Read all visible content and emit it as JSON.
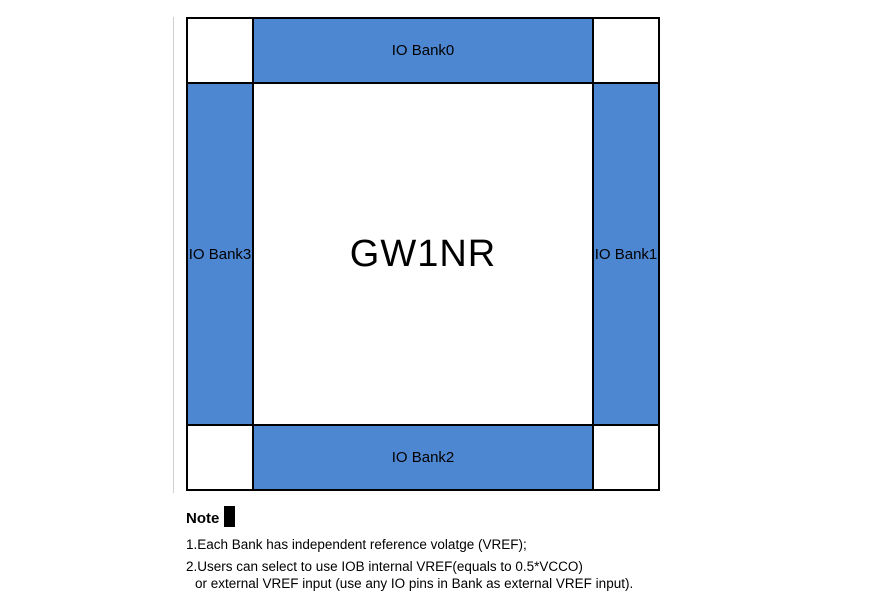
{
  "diagram": {
    "chip_label": "GW1NR",
    "banks": {
      "top": "IO Bank0",
      "right": "IO Bank1",
      "bottom": "IO Bank2",
      "left": "IO Bank3"
    },
    "colors": {
      "bank_fill": "#4E87D1",
      "grid_line": "#000000",
      "background": "#ffffff"
    }
  },
  "note": {
    "heading": "Note",
    "items": [
      "1.Each Bank has independent reference volatge (VREF);",
      "2.Users can select to use IOB internal VREF(equals to 0.5*VCCO)",
      "or external VREF input (use any IO pins in Bank as external VREF input)."
    ]
  }
}
